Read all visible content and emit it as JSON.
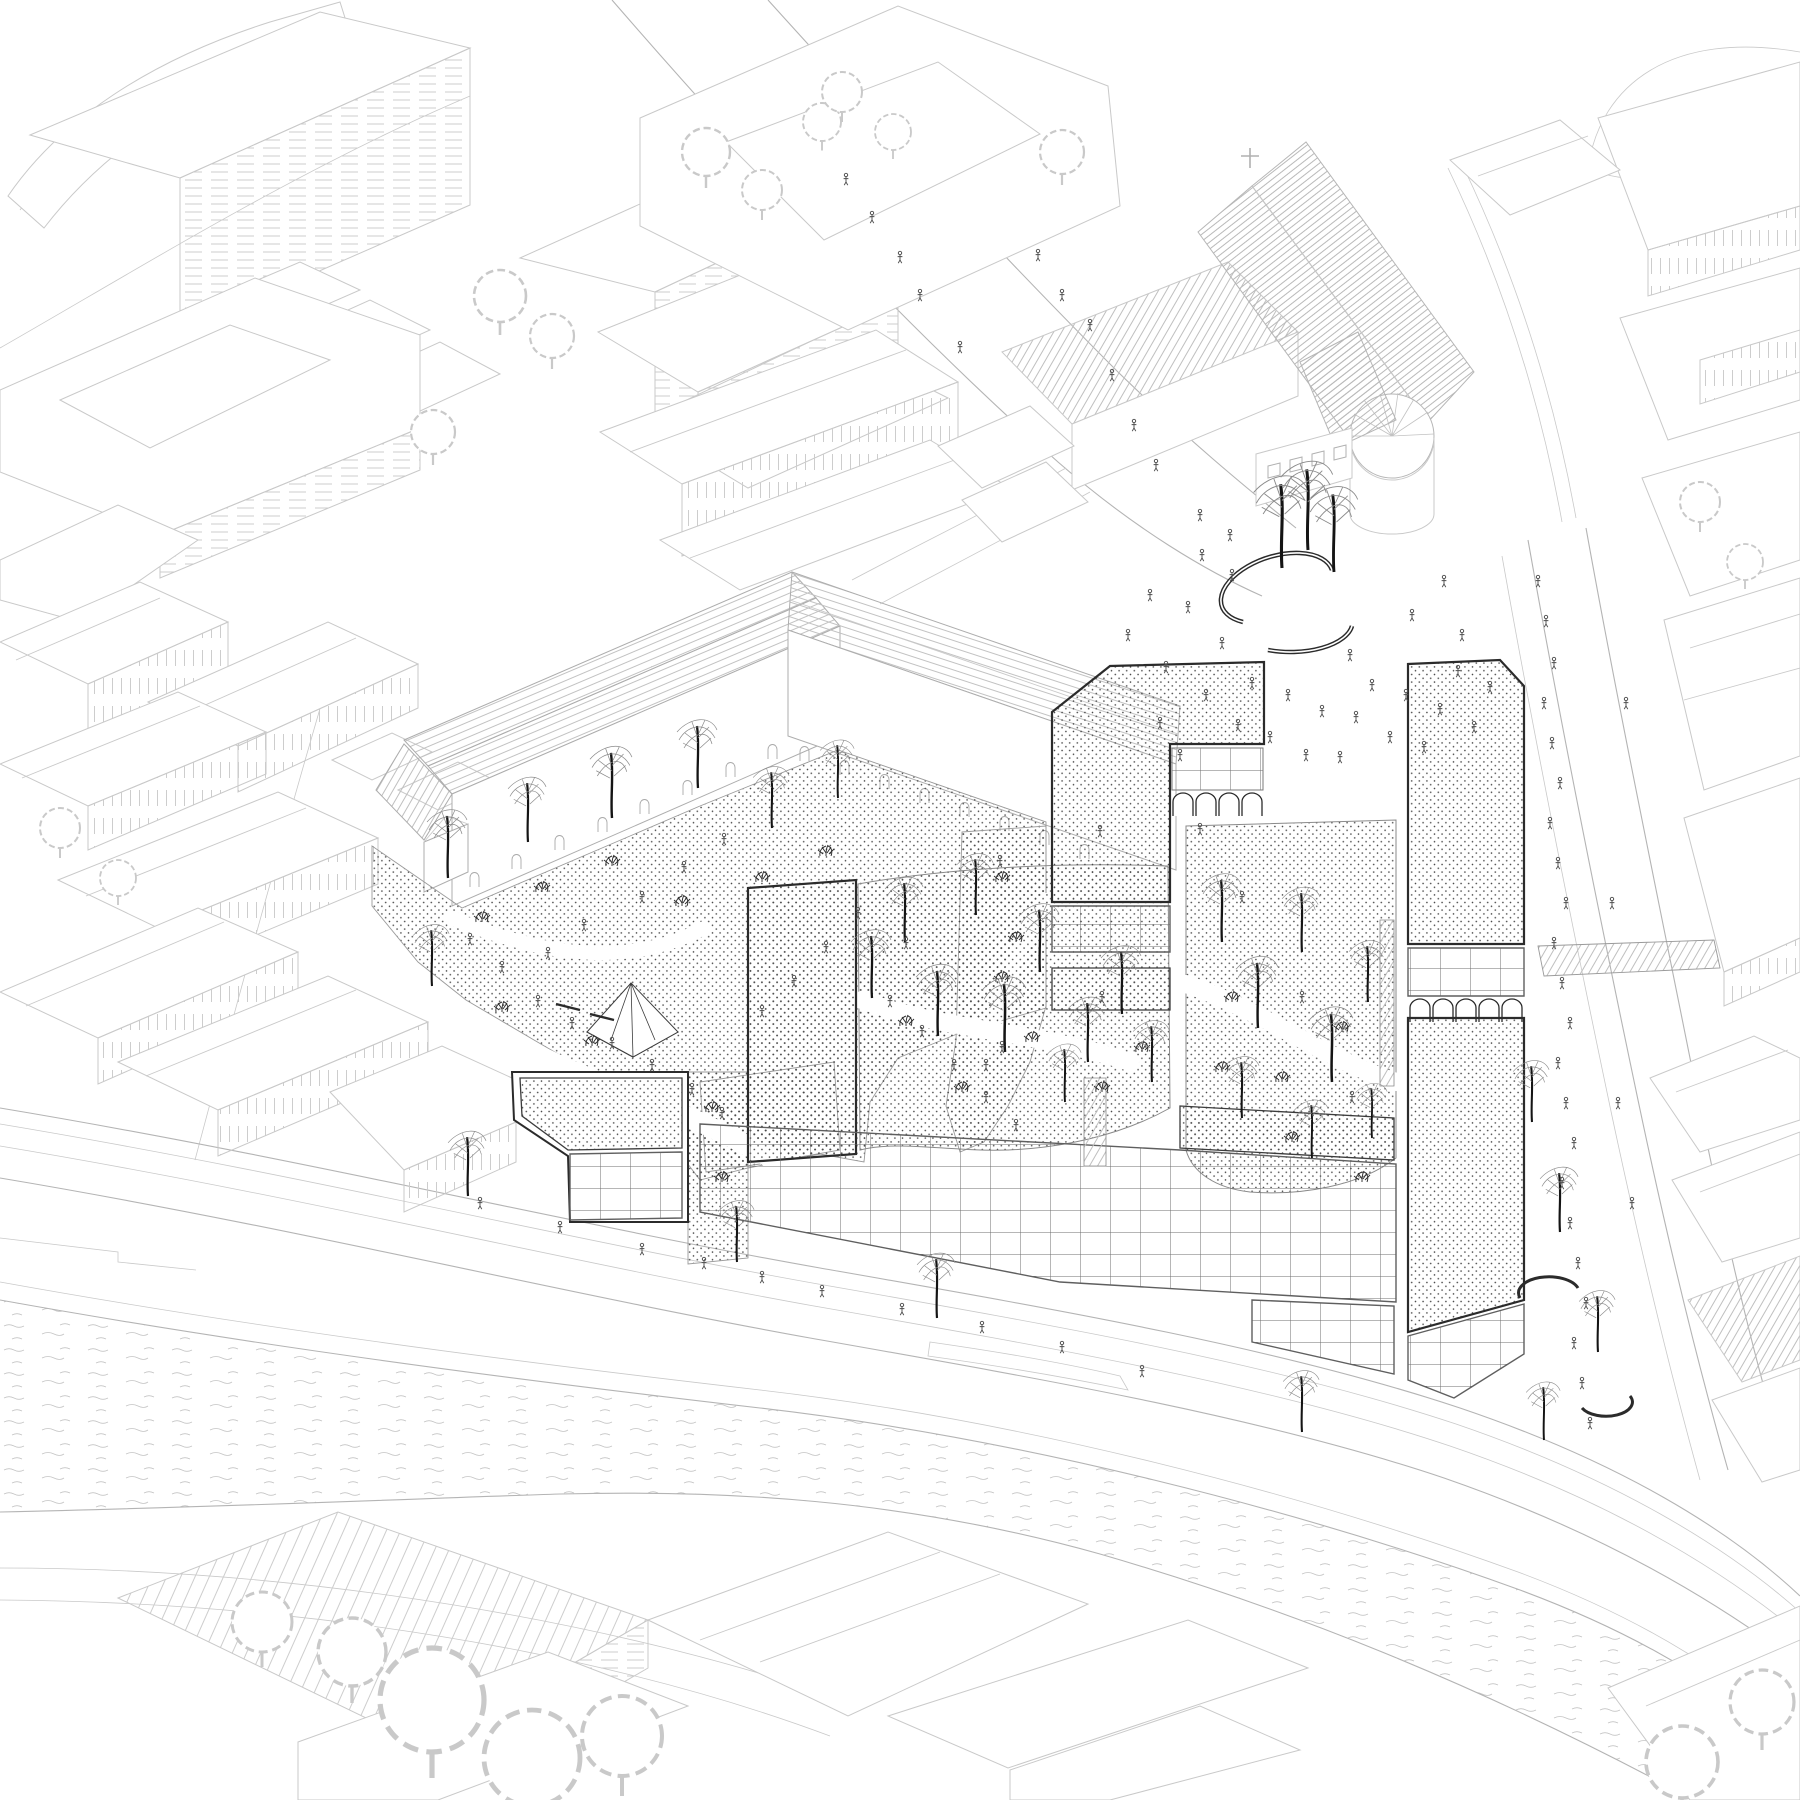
{
  "meta": {
    "kind": "architectural-axonometric-masterplan-drawing",
    "style": "black-and-white line drawing, isometric bird's-eye view",
    "content": "proposed riverside urban development with stippled roofs, glass grid facades, arcades, courtyard gardens, plazas with trees and people, surrounded by light line-drawn city fabric, church with round apse, and a river with ripple lines"
  },
  "colors": {
    "bg": "#ffffff",
    "ctx": "#c9c9c9",
    "ctx2": "#b4b4b4",
    "ctx3": "#adadad",
    "site": "#2b2b2b",
    "dots": "#474747",
    "gridline": "#6e6e6e",
    "water": "#c4c4c4",
    "people": "#4f4f4f",
    "trunk": "#141414",
    "canopy": "#8a8a8a",
    "shrub": "#2e2e2e"
  },
  "scene": {
    "people": [
      [
        1128,
        640
      ],
      [
        1150,
        600
      ],
      [
        1166,
        672
      ],
      [
        1188,
        612
      ],
      [
        1206,
        700
      ],
      [
        1222,
        648
      ],
      [
        1238,
        730
      ],
      [
        1252,
        688
      ],
      [
        1270,
        742
      ],
      [
        1288,
        700
      ],
      [
        1306,
        760
      ],
      [
        1322,
        716
      ],
      [
        1340,
        762
      ],
      [
        1356,
        722
      ],
      [
        1372,
        690
      ],
      [
        1390,
        742
      ],
      [
        1406,
        700
      ],
      [
        1424,
        752
      ],
      [
        1440,
        714
      ],
      [
        1458,
        676
      ],
      [
        1474,
        732
      ],
      [
        1490,
        692
      ],
      [
        1202,
        560
      ],
      [
        1232,
        580
      ],
      [
        1412,
        620
      ],
      [
        1444,
        586
      ],
      [
        1462,
        640
      ],
      [
        1160,
        728
      ],
      [
        1180,
        760
      ],
      [
        1350,
        660
      ],
      [
        1090,
        330
      ],
      [
        1112,
        380
      ],
      [
        1134,
        430
      ],
      [
        1156,
        470
      ],
      [
        1062,
        300
      ],
      [
        1038,
        260
      ],
      [
        1200,
        520
      ],
      [
        1230,
        540
      ],
      [
        920,
        300
      ],
      [
        900,
        262
      ],
      [
        872,
        222
      ],
      [
        846,
        184
      ],
      [
        960,
        352
      ],
      [
        470,
        944
      ],
      [
        502,
        972
      ],
      [
        538,
        1006
      ],
      [
        572,
        1028
      ],
      [
        612,
        1048
      ],
      [
        652,
        1070
      ],
      [
        692,
        1094
      ],
      [
        722,
        1118
      ],
      [
        762,
        1016
      ],
      [
        794,
        986
      ],
      [
        826,
        952
      ],
      [
        858,
        918
      ],
      [
        890,
        1006
      ],
      [
        922,
        1036
      ],
      [
        954,
        1070
      ],
      [
        986,
        1102
      ],
      [
        1016,
        1130
      ],
      [
        548,
        958
      ],
      [
        584,
        930
      ],
      [
        642,
        902
      ],
      [
        684,
        872
      ],
      [
        724,
        844
      ],
      [
        1538,
        586
      ],
      [
        1546,
        626
      ],
      [
        1554,
        668
      ],
      [
        1544,
        708
      ],
      [
        1552,
        748
      ],
      [
        1560,
        788
      ],
      [
        1550,
        828
      ],
      [
        1558,
        868
      ],
      [
        1566,
        908
      ],
      [
        1554,
        948
      ],
      [
        1562,
        988
      ],
      [
        1570,
        1028
      ],
      [
        1558,
        1068
      ],
      [
        1566,
        1108
      ],
      [
        1574,
        1148
      ],
      [
        1562,
        1188
      ],
      [
        1570,
        1228
      ],
      [
        1578,
        1268
      ],
      [
        1586,
        1308
      ],
      [
        1574,
        1348
      ],
      [
        1582,
        1388
      ],
      [
        1590,
        1428
      ],
      [
        1618,
        1108
      ],
      [
        1632,
        1208
      ],
      [
        1612,
        908
      ],
      [
        1626,
        708
      ],
      [
        1242,
        902
      ],
      [
        1302,
        1002
      ],
      [
        1352,
        1102
      ],
      [
        906,
        948
      ],
      [
        1002,
        1052
      ],
      [
        1102,
        1002
      ],
      [
        1000,
        866
      ],
      [
        986,
        1070
      ],
      [
        1100,
        836
      ],
      [
        1200,
        834
      ],
      [
        480,
        1208
      ],
      [
        560,
        1232
      ],
      [
        642,
        1254
      ],
      [
        704,
        1268
      ],
      [
        762,
        1282
      ],
      [
        822,
        1296
      ],
      [
        902,
        1314
      ],
      [
        982,
        1332
      ],
      [
        1062,
        1352
      ],
      [
        1142,
        1376
      ]
    ],
    "site_trees": [
      [
        872,
        998,
        1
      ],
      [
        905,
        942,
        0.95
      ],
      [
        938,
        1036,
        1.05
      ],
      [
        976,
        915,
        0.9
      ],
      [
        1005,
        1052,
        1.1
      ],
      [
        1040,
        972,
        1
      ],
      [
        1088,
        1062,
        0.95
      ],
      [
        1122,
        1014,
        1
      ],
      [
        1152,
        1082,
        0.9
      ],
      [
        1065,
        1102,
        0.85
      ],
      [
        1222,
        942,
        1
      ],
      [
        1258,
        1028,
        1.05
      ],
      [
        1302,
        952,
        0.95
      ],
      [
        1332,
        1082,
        1.1
      ],
      [
        1368,
        1002,
        0.9
      ],
      [
        1242,
        1118,
        0.9
      ],
      [
        1312,
        1158,
        0.85
      ],
      [
        1372,
        1138,
        0.8
      ],
      [
        448,
        878,
        1
      ],
      [
        528,
        842,
        0.95
      ],
      [
        612,
        818,
        1.05
      ],
      [
        698,
        788,
        1
      ],
      [
        772,
        828,
        0.9
      ],
      [
        838,
        798,
        0.85
      ],
      [
        432,
        986,
        0.9
      ],
      [
        1282,
        568,
        1.35
      ],
      [
        1308,
        550,
        1.3
      ],
      [
        1334,
        572,
        1.25
      ],
      [
        468,
        1196,
        0.95
      ],
      [
        737,
        1262,
        0.9
      ],
      [
        937,
        1318,
        0.95
      ],
      [
        1302,
        1432,
        0.9
      ],
      [
        1532,
        1122,
        0.9
      ],
      [
        1560,
        1232,
        0.95
      ],
      [
        1598,
        1352,
        0.9
      ],
      [
        1544,
        1440,
        0.85
      ]
    ],
    "shrubs": [
      [
        482,
        922
      ],
      [
        542,
        892
      ],
      [
        612,
        866
      ],
      [
        682,
        906
      ],
      [
        762,
        882
      ],
      [
        826,
        856
      ],
      [
        502,
        1012
      ],
      [
        592,
        1046
      ],
      [
        906,
        1026
      ],
      [
        962,
        1092
      ],
      [
        1032,
        1042
      ],
      [
        1102,
        1092
      ],
      [
        1142,
        1052
      ],
      [
        1002,
        982
      ],
      [
        1232,
        1002
      ],
      [
        1282,
        1082
      ],
      [
        1342,
        1032
      ],
      [
        1292,
        1142
      ],
      [
        1362,
        1182
      ],
      [
        1222,
        1072
      ],
      [
        1002,
        882
      ],
      [
        1016,
        942
      ],
      [
        712,
        1112
      ],
      [
        722,
        1182
      ]
    ],
    "context_trees": [
      [
        500,
        296,
        2.6
      ],
      [
        552,
        336,
        2.2
      ],
      [
        433,
        432,
        2.2
      ],
      [
        706,
        152,
        2.4
      ],
      [
        762,
        190,
        2.0
      ],
      [
        822,
        122,
        1.9
      ],
      [
        60,
        828,
        2.0
      ],
      [
        118,
        878,
        1.8
      ],
      [
        842,
        92,
        2.0
      ],
      [
        893,
        132,
        1.8
      ],
      [
        1062,
        152,
        2.2
      ],
      [
        1700,
        502,
        2.0
      ],
      [
        1745,
        562,
        1.8
      ],
      [
        432,
        1700,
        5.2
      ],
      [
        532,
        1758,
        4.8
      ],
      [
        352,
        1652,
        3.4
      ],
      [
        622,
        1736,
        4.0
      ],
      [
        262,
        1622,
        3.0
      ],
      [
        1682,
        1762,
        3.6
      ],
      [
        1762,
        1702,
        3.2
      ]
    ]
  }
}
